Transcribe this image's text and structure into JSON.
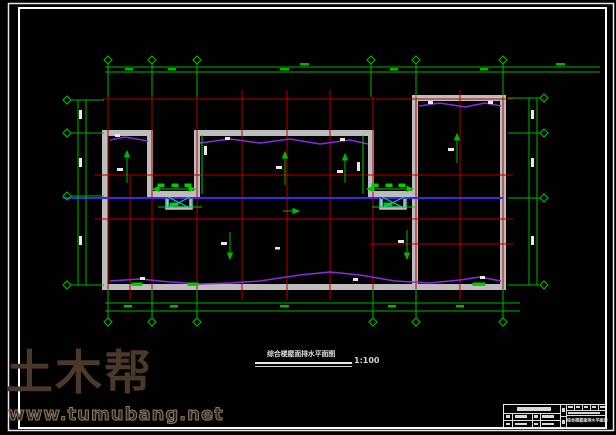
{
  "drawing": {
    "title": "综合楼屋面排水平面图",
    "scale": "1:100"
  },
  "title_block": {
    "drawing_title": "综合楼屋面排水平面图"
  },
  "watermark": {
    "brand": "土木帮",
    "url": "www.tumubang.net"
  },
  "colors": {
    "background": "#010101",
    "frame_white": "#f0f0f0",
    "grid_red": "#b40000",
    "axis_green": "#00b400",
    "wall_gray": "#bdbdbd",
    "drain_purple": "#8a2be2",
    "drain_blue": "#4422ee",
    "detail_cyan": "#00c8c8",
    "annotation_white": "#e8e8e8",
    "watermark_brown": "#4a382a"
  }
}
